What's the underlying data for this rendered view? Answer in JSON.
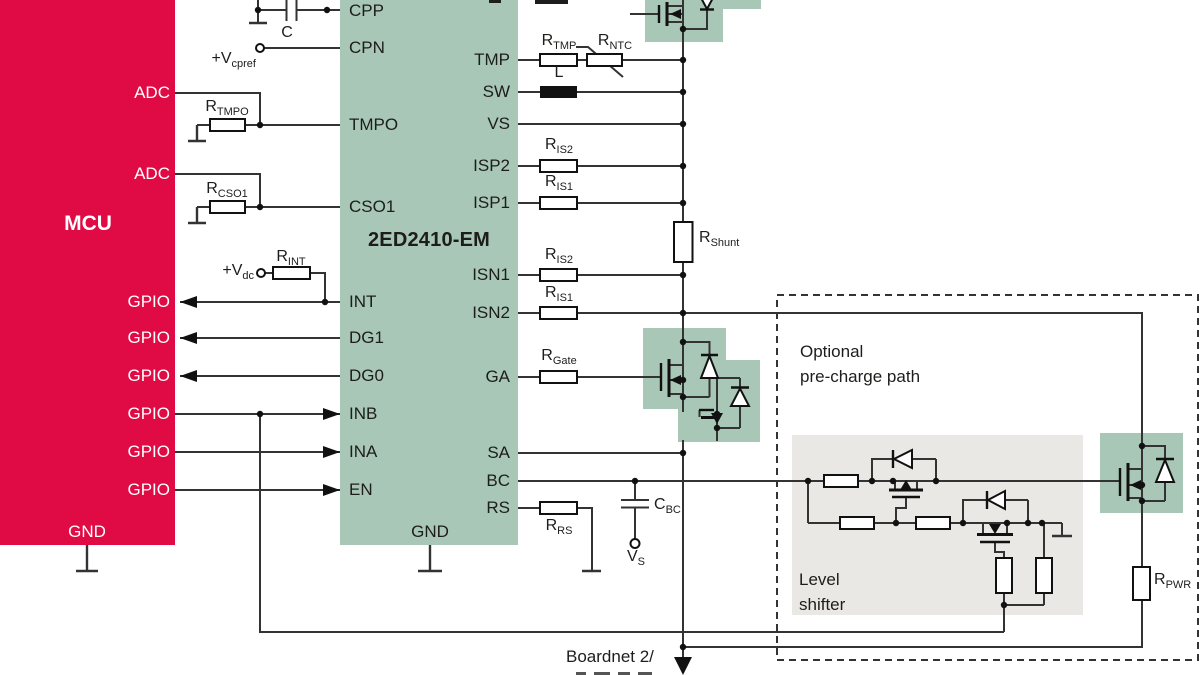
{
  "colors": {
    "mcu_red": "#e00a44",
    "chip_green": "#a8c7b6",
    "component_box_green": "#a8c7b6",
    "level_shifter_gray": "#e9e8e5",
    "wire": "#333333",
    "symbol": "#111111",
    "text": "#1d1d1b",
    "text_on_red": "#ffffff"
  },
  "mcu": {
    "title": "MCU",
    "gnd": "GND",
    "side_labels": [
      "ADC",
      "ADC",
      "GPIO",
      "GPIO",
      "GPIO",
      "GPIO",
      "GPIO",
      "GPIO"
    ]
  },
  "chip": {
    "title": "2ED2410-EM",
    "gnd": "GND",
    "left_pins": [
      "CPP",
      "CPN",
      "TMPO",
      "CSO1",
      "INT",
      "DG1",
      "DG0",
      "INB",
      "INA",
      "EN"
    ],
    "right_pins": [
      "TMP",
      "SW",
      "VS",
      "ISP2",
      "ISP1",
      "ISN1",
      "ISN2",
      "GA",
      "SA",
      "BC",
      "RS"
    ]
  },
  "labels": {
    "r_tmpo": {
      "base": "R",
      "sub": "TMPO"
    },
    "r_cso1": {
      "base": "R",
      "sub": "CSO1"
    },
    "r_int": {
      "base": "R",
      "sub": "INT"
    },
    "v_cpref": {
      "base": "+V",
      "sub": "cpref"
    },
    "v_dc": {
      "base": "+V",
      "sub": "dc"
    },
    "c_top": {
      "base": "C",
      "sub": ""
    },
    "r_tmp": {
      "base": "R",
      "sub": "TMP"
    },
    "r_ntc": {
      "base": "R",
      "sub": "NTC"
    },
    "l_ind": {
      "base": "L",
      "sub": ""
    },
    "r_is2_a": {
      "base": "R",
      "sub": "IS2"
    },
    "r_is1_a": {
      "base": "R",
      "sub": "IS1"
    },
    "r_shunt": {
      "base": "R",
      "sub": "Shunt"
    },
    "r_is2_b": {
      "base": "R",
      "sub": "IS2"
    },
    "r_is1_b": {
      "base": "R",
      "sub": "IS1"
    },
    "r_gate": {
      "base": "R",
      "sub": "Gate"
    },
    "r_rs": {
      "base": "R",
      "sub": "RS"
    },
    "c_bc": {
      "base": "C",
      "sub": "BC"
    },
    "v_s": {
      "base": "V",
      "sub": "S"
    },
    "r_pwr": {
      "base": "R",
      "sub": "PWR"
    }
  },
  "annotations": {
    "optional_line1": "Optional",
    "optional_line2": "pre-charge path",
    "level_line1": "Level",
    "level_line2": "shifter",
    "boardnet": "Boardnet 2/"
  }
}
